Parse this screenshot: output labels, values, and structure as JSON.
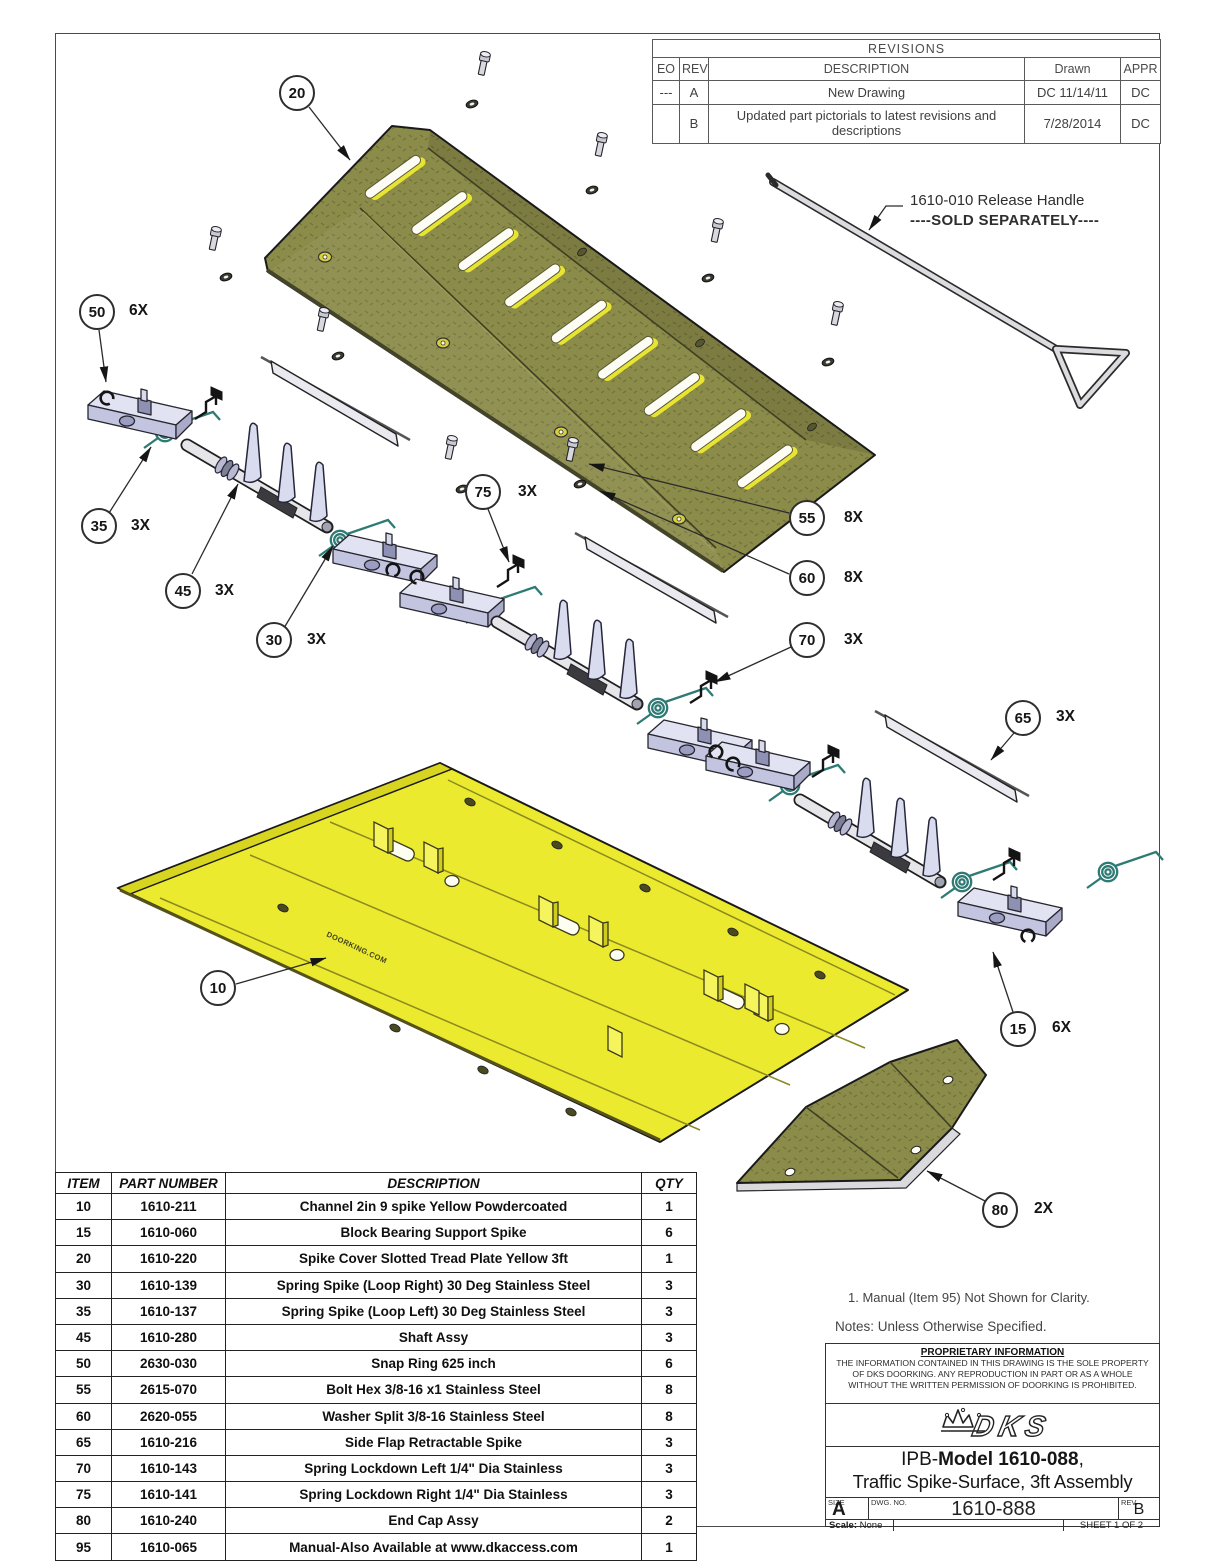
{
  "revisions": {
    "title": "REVISIONS",
    "headers": {
      "eo": "EO",
      "rev": "REV",
      "description": "DESCRIPTION",
      "drawn": "Drawn",
      "appr": "APPR"
    },
    "rows": [
      {
        "eo": "---",
        "rev": "A",
        "description": "New Drawing",
        "drawn": "DC 11/14/11",
        "appr": "DC"
      },
      {
        "eo": "",
        "rev": "B",
        "description": "Updated part pictorials to latest revisions and descriptions",
        "drawn": "7/28/2014",
        "appr": "DC"
      }
    ]
  },
  "release_handle": {
    "line1": "1610-010 Release Handle",
    "line2": "----SOLD SEPARATELY----"
  },
  "callouts": [
    {
      "num": "20",
      "qty": ""
    },
    {
      "num": "50",
      "qty": "6X"
    },
    {
      "num": "35",
      "qty": "3X"
    },
    {
      "num": "45",
      "qty": "3X"
    },
    {
      "num": "30",
      "qty": "3X"
    },
    {
      "num": "75",
      "qty": "3X"
    },
    {
      "num": "55",
      "qty": "8X"
    },
    {
      "num": "60",
      "qty": "8X"
    },
    {
      "num": "70",
      "qty": "3X"
    },
    {
      "num": "65",
      "qty": "3X"
    },
    {
      "num": "10",
      "qty": ""
    },
    {
      "num": "15",
      "qty": "6X"
    },
    {
      "num": "80",
      "qty": "2X"
    }
  ],
  "diagram": {
    "doorking_text": "DOORKING.COM",
    "colors": {
      "plate_olive": "#8b8b4a",
      "plate_olive_dark": "#72723a",
      "channel_yellow": "#ecea2e",
      "spring_teal": "#2e7a74",
      "part_lavender": "#d9dbee"
    }
  },
  "parts_table": {
    "headers": {
      "item": "ITEM",
      "part": "PART NUMBER",
      "description": "DESCRIPTION",
      "qty": "QTY"
    },
    "rows": [
      {
        "item": "10",
        "part": "1610-211",
        "description": "Channel 2in 9 spike Yellow Powdercoated",
        "qty": "1"
      },
      {
        "item": "15",
        "part": "1610-060",
        "description": "Block Bearing Support Spike",
        "qty": "6"
      },
      {
        "item": "20",
        "part": "1610-220",
        "description": "Spike Cover Slotted Tread Plate Yellow 3ft",
        "qty": "1"
      },
      {
        "item": "30",
        "part": "1610-139",
        "description": "Spring Spike (Loop Right) 30 Deg Stainless Steel",
        "qty": "3"
      },
      {
        "item": "35",
        "part": "1610-137",
        "description": "Spring Spike (Loop Left) 30 Deg Stainless Steel",
        "qty": "3"
      },
      {
        "item": "45",
        "part": "1610-280",
        "description": "Shaft Assy",
        "qty": "3"
      },
      {
        "item": "50",
        "part": "2630-030",
        "description": "Snap Ring 625 inch",
        "qty": "6"
      },
      {
        "item": "55",
        "part": "2615-070",
        "description": "Bolt Hex 3/8-16 x1 Stainless Steel",
        "qty": "8"
      },
      {
        "item": "60",
        "part": "2620-055",
        "description": "Washer Split 3/8-16 Stainless Steel",
        "qty": "8"
      },
      {
        "item": "65",
        "part": "1610-216",
        "description": "Side Flap Retractable Spike",
        "qty": "3"
      },
      {
        "item": "70",
        "part": "1610-143",
        "description": "Spring Lockdown Left 1/4\" Dia Stainless",
        "qty": "3"
      },
      {
        "item": "75",
        "part": "1610-141",
        "description": "Spring Lockdown Right 1/4\" Dia Stainless",
        "qty": "3"
      },
      {
        "item": "80",
        "part": "1610-240",
        "description": "End Cap Assy",
        "qty": "2"
      },
      {
        "item": "95",
        "part": "1610-065",
        "description": "Manual-Also Available at www.dkaccess.com",
        "qty": "1"
      }
    ]
  },
  "notes": {
    "note1": "1.  Manual (Item 95) Not Shown for Clarity.",
    "heading": "Notes: Unless Otherwise Specified."
  },
  "title_block": {
    "proprietary_title": "PROPRIETARY INFORMATION",
    "proprietary_lines": [
      "THE INFORMATION CONTAINED IN THIS DRAWING IS THE SOLE PROPERTY",
      "OF DKS DOORKING.  ANY REPRODUCTION IN PART OR AS A WHOLE",
      "WITHOUT THE WRITTEN PERMISSION OF DOORKING IS PROHIBITED."
    ],
    "logo_text": "DKS",
    "title_prefix": "IPB-",
    "title_bold": "Model 1610-088",
    "title_comma": ",",
    "title_line2": "Traffic Spike-Surface, 3ft Assembly",
    "size_label": "SIZE",
    "size_value": "A",
    "dwg_label": "DWG.  NO.",
    "dwg_value": "1610-888",
    "rev_label": "REV.",
    "rev_value": "B",
    "scale_label": "Scale:",
    "scale_value": "None",
    "sheet_label": "SHEET 1 OF 2"
  }
}
